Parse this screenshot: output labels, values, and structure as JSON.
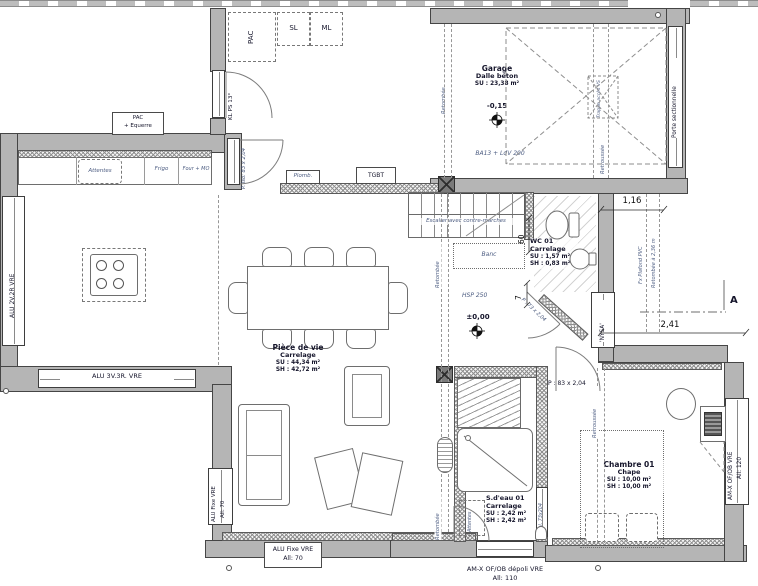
{
  "rooms": {
    "garage": {
      "name": "Garage",
      "floor": "Dalle béton",
      "su": "SU : 23,38 m²",
      "level": "-0,15",
      "note": "BA13 + LdV 200"
    },
    "living": {
      "name": "Pièce de vie",
      "floor": "Carrelage",
      "su": "SU : 44,34 m²",
      "sh": "SH : 42,72 m²",
      "level": "±0,00",
      "hsp": "HSP 250"
    },
    "wc": {
      "name": "WC 01",
      "floor": "Carrelage",
      "su": "SU : 1,57 m²",
      "sh": "SH : 0,83 m²"
    },
    "bath": {
      "name": "S.d'eau 01",
      "floor": "Carrelage",
      "su": "SU : 2,42 m²",
      "sh": "SH : 2,42 m²"
    },
    "bedroom": {
      "name": "Chambre 01",
      "floor": "Chape",
      "su": "SU : 10,00 m²",
      "sh": "SH : 10,00 m²"
    }
  },
  "cellier": {
    "pac": "PAC",
    "sl": "SL",
    "ml": "ML"
  },
  "kitchen": {
    "attentes": "Attentes",
    "frigo": "Frigo",
    "four": "Four + MO",
    "pac_eq1": "PAC",
    "pac_eq2": "+ Equerre"
  },
  "hall": {
    "plomb": "Plomb.",
    "tgbt": "TGBT"
  },
  "stair": {
    "label": "Escalier avec contre-marches",
    "banc": "Banc"
  },
  "doors": {
    "entry": "P. Iso: 83 x 2,04",
    "cellier": "KL PS 13°",
    "bedroom": "P : 83 x 2,04",
    "wc": "P : 73 x 2,04",
    "bath_slide": "P.Gal. 73x204",
    "sectional": "Porte sectionnelle"
  },
  "windows": {
    "kitchen_side": "ALU 2V.2R VRE",
    "kitchen_front": "ALU 3V.3R. VRE",
    "alu_fixe": "ALU Fixe VRE",
    "all70": "All: 70",
    "bath_1": "AM-X OF/OB dépoli VRE",
    "bath_2": "All: 110",
    "nysa": "'NYSA'",
    "bedroom_1": "AM-X OF/OB VRE",
    "bedroom_2": "All: 120"
  },
  "dims": {
    "w116": "1,16",
    "w241": "2,41",
    "h60": "60",
    "h7": "7"
  },
  "ann": {
    "retombee": "Retombée",
    "retroussee": "Retroussée",
    "fx_plafond": "Fx Plafond PVC",
    "retombee236": "Retombée à 2,36 m",
    "trappe": "Trappe accès VS",
    "attentes_bath": "Attentes",
    "section_a": "A"
  }
}
